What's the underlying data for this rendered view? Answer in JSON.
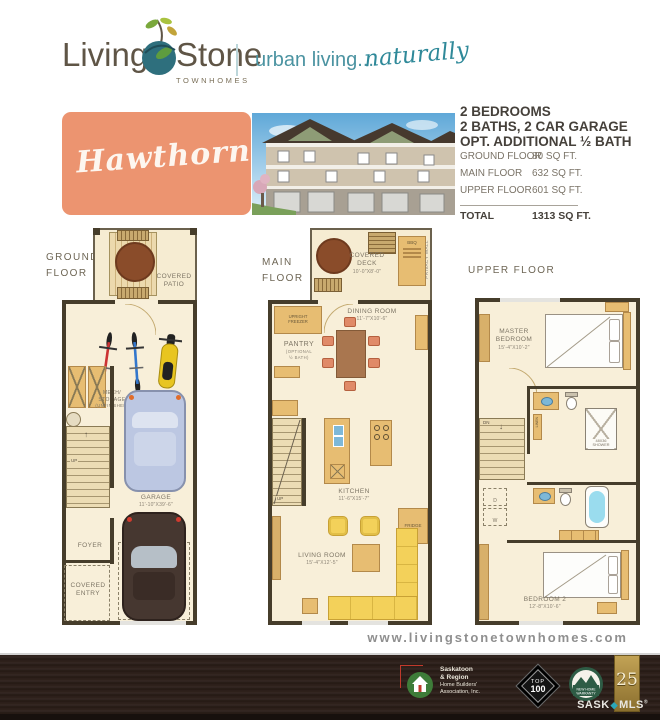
{
  "brand": {
    "name_living": "Living",
    "name_stone": "Stone",
    "townhomes": "TOWNHOMES",
    "tagline": "urban living...",
    "tagline_script": "naturally"
  },
  "model": {
    "name": "Hawthorn"
  },
  "specs": {
    "headline1": "2 BEDROOMS",
    "headline2": "2 BATHS, 2 CAR GARAGE",
    "headline3": "OPT. ADDITIONAL ½ BATH",
    "rows": [
      {
        "label": "GROUND FLOOR",
        "value": "80 SQ FT."
      },
      {
        "label": "MAIN FLOOR",
        "value": "632 SQ FT."
      },
      {
        "label": "UPPER FLOOR",
        "value": "601 SQ FT."
      }
    ],
    "total_label": "TOTAL",
    "total_value": "1313 SQ FT."
  },
  "plans": {
    "ground": {
      "title": "GROUND\nFLOOR",
      "covered_patio": "COVERED\nPATIO",
      "mech": "MECH/\nSTORAGE",
      "mech_sub": "(UNFINISHED)",
      "up": "UP",
      "garage": "GARAGE",
      "garage_dims": "11'-10\"X39'-6\"",
      "foyer": "FOYER",
      "covered_entry": "COVERED\nENTRY"
    },
    "main": {
      "title": "MAIN\nFLOOR",
      "covered_deck": "COVERED\nDECK",
      "covered_deck_dims": "10'-0\"X8'-0\"",
      "bbq": "BBQ",
      "privacy_wall": "PRIVACY WALL",
      "upright_freezer": "UPRIGHT\nFREEZER",
      "pantry": "PANTRY",
      "pantry_sub": "(OPTIONAL\n½ BATH)",
      "dining_room": "DINING ROOM",
      "dining_room_dims": "11'-7\"X10'-6\"",
      "kitchen": "KITCHEN",
      "kitchen_dims": "11'-6\"X15'-7\"",
      "fridge": "FRIDGE",
      "up": "UP",
      "living_room": "LIVING ROOM",
      "living_room_dims": "15'-4\"X12'-5\""
    },
    "upper": {
      "title": "UPPER FLOOR",
      "master_bedroom": "MASTER\nBEDROOM",
      "master_bedroom_dims": "15'-4\"X10'-2\"",
      "dn": "DN",
      "shower": "48X36\nSHOWER",
      "linen": "LINEN",
      "washer": "W",
      "dryer": "D",
      "bedroom2": "BEDROOM 2",
      "bedroom2_dims": "12'-8\"X10'-6\""
    }
  },
  "footer": {
    "url": "www.livingstonetownhomes.com",
    "hba_name1": "Saskatoon",
    "hba_name2": "& Region",
    "hba_name3": "Home Builders'",
    "hba_name4": "Association, Inc.",
    "top100_top": "TOP",
    "top100_num": "100",
    "warranty_line1": "NEW HOME",
    "warranty_line2": "WARRANTY",
    "anniversary": "25",
    "sask": "SASK",
    "mls": "MLS",
    "registered": "®"
  },
  "icons": {
    "up_arrow": "↑",
    "down_arrow": "↓",
    "diamond": "◆"
  },
  "colors": {
    "salmon": "#ec9470",
    "teal": "#4793a1",
    "brand_brown": "#5c5140",
    "plan_wall": "#463d2b",
    "plan_floor": "#f8efd9",
    "furniture_tan": "#e7bd72",
    "sofa_yellow": "#f3d158",
    "footer_wood": "#2c201b"
  }
}
